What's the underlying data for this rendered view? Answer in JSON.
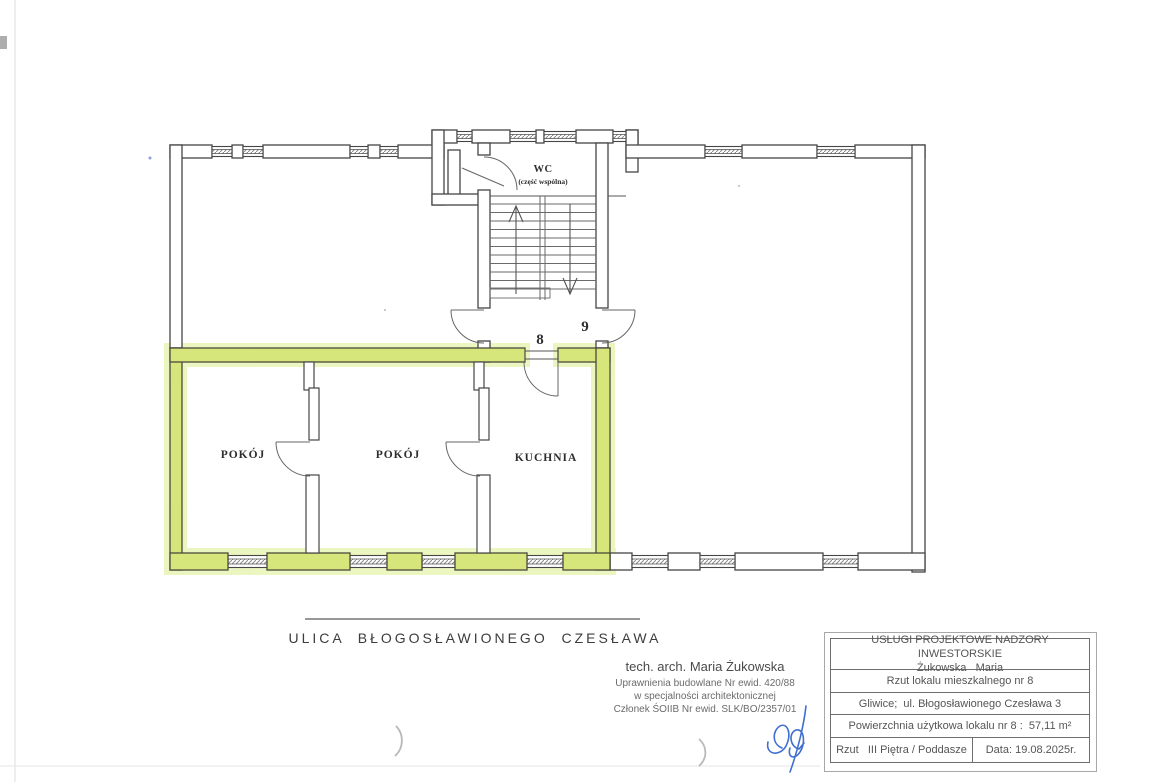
{
  "plan": {
    "labels": {
      "wc": "WC",
      "wc_sub": "(część wspólna)",
      "room1": "POKÓJ",
      "room2": "POKÓJ",
      "kitchen": "KUCHNIA",
      "unit8": "8",
      "unit9": "9"
    },
    "highlight_color": "#d7e67b"
  },
  "street_label": "ULICA  BŁOGOSŁAWIONEGO  CZESŁAWA",
  "architect": {
    "line1": "tech. arch. Maria Żukowska",
    "line2": "Uprawnienia budowlane Nr ewid. 420/88",
    "line3": "w specjalności architektonicznej",
    "line4": "Członek ŚOIIB Nr ewid. SLK/BO/2357/01"
  },
  "title_block": {
    "company_line1": "USŁUGI PROJEKTOWE NADZORY INWESTORSKIE",
    "company_line2": "Żukowska   Maria",
    "drawing_title": "Rzut lokalu mieszkalnego nr 8",
    "address": "Gliwice;  ul. Błogosławionego Czesława 3",
    "area": "Powierzchnia użytkowa lokalu nr 8 :  57,11 m²",
    "floor": "Rzut   III Piętra / Poddasze",
    "date": "Data: 19.08.2025r."
  }
}
